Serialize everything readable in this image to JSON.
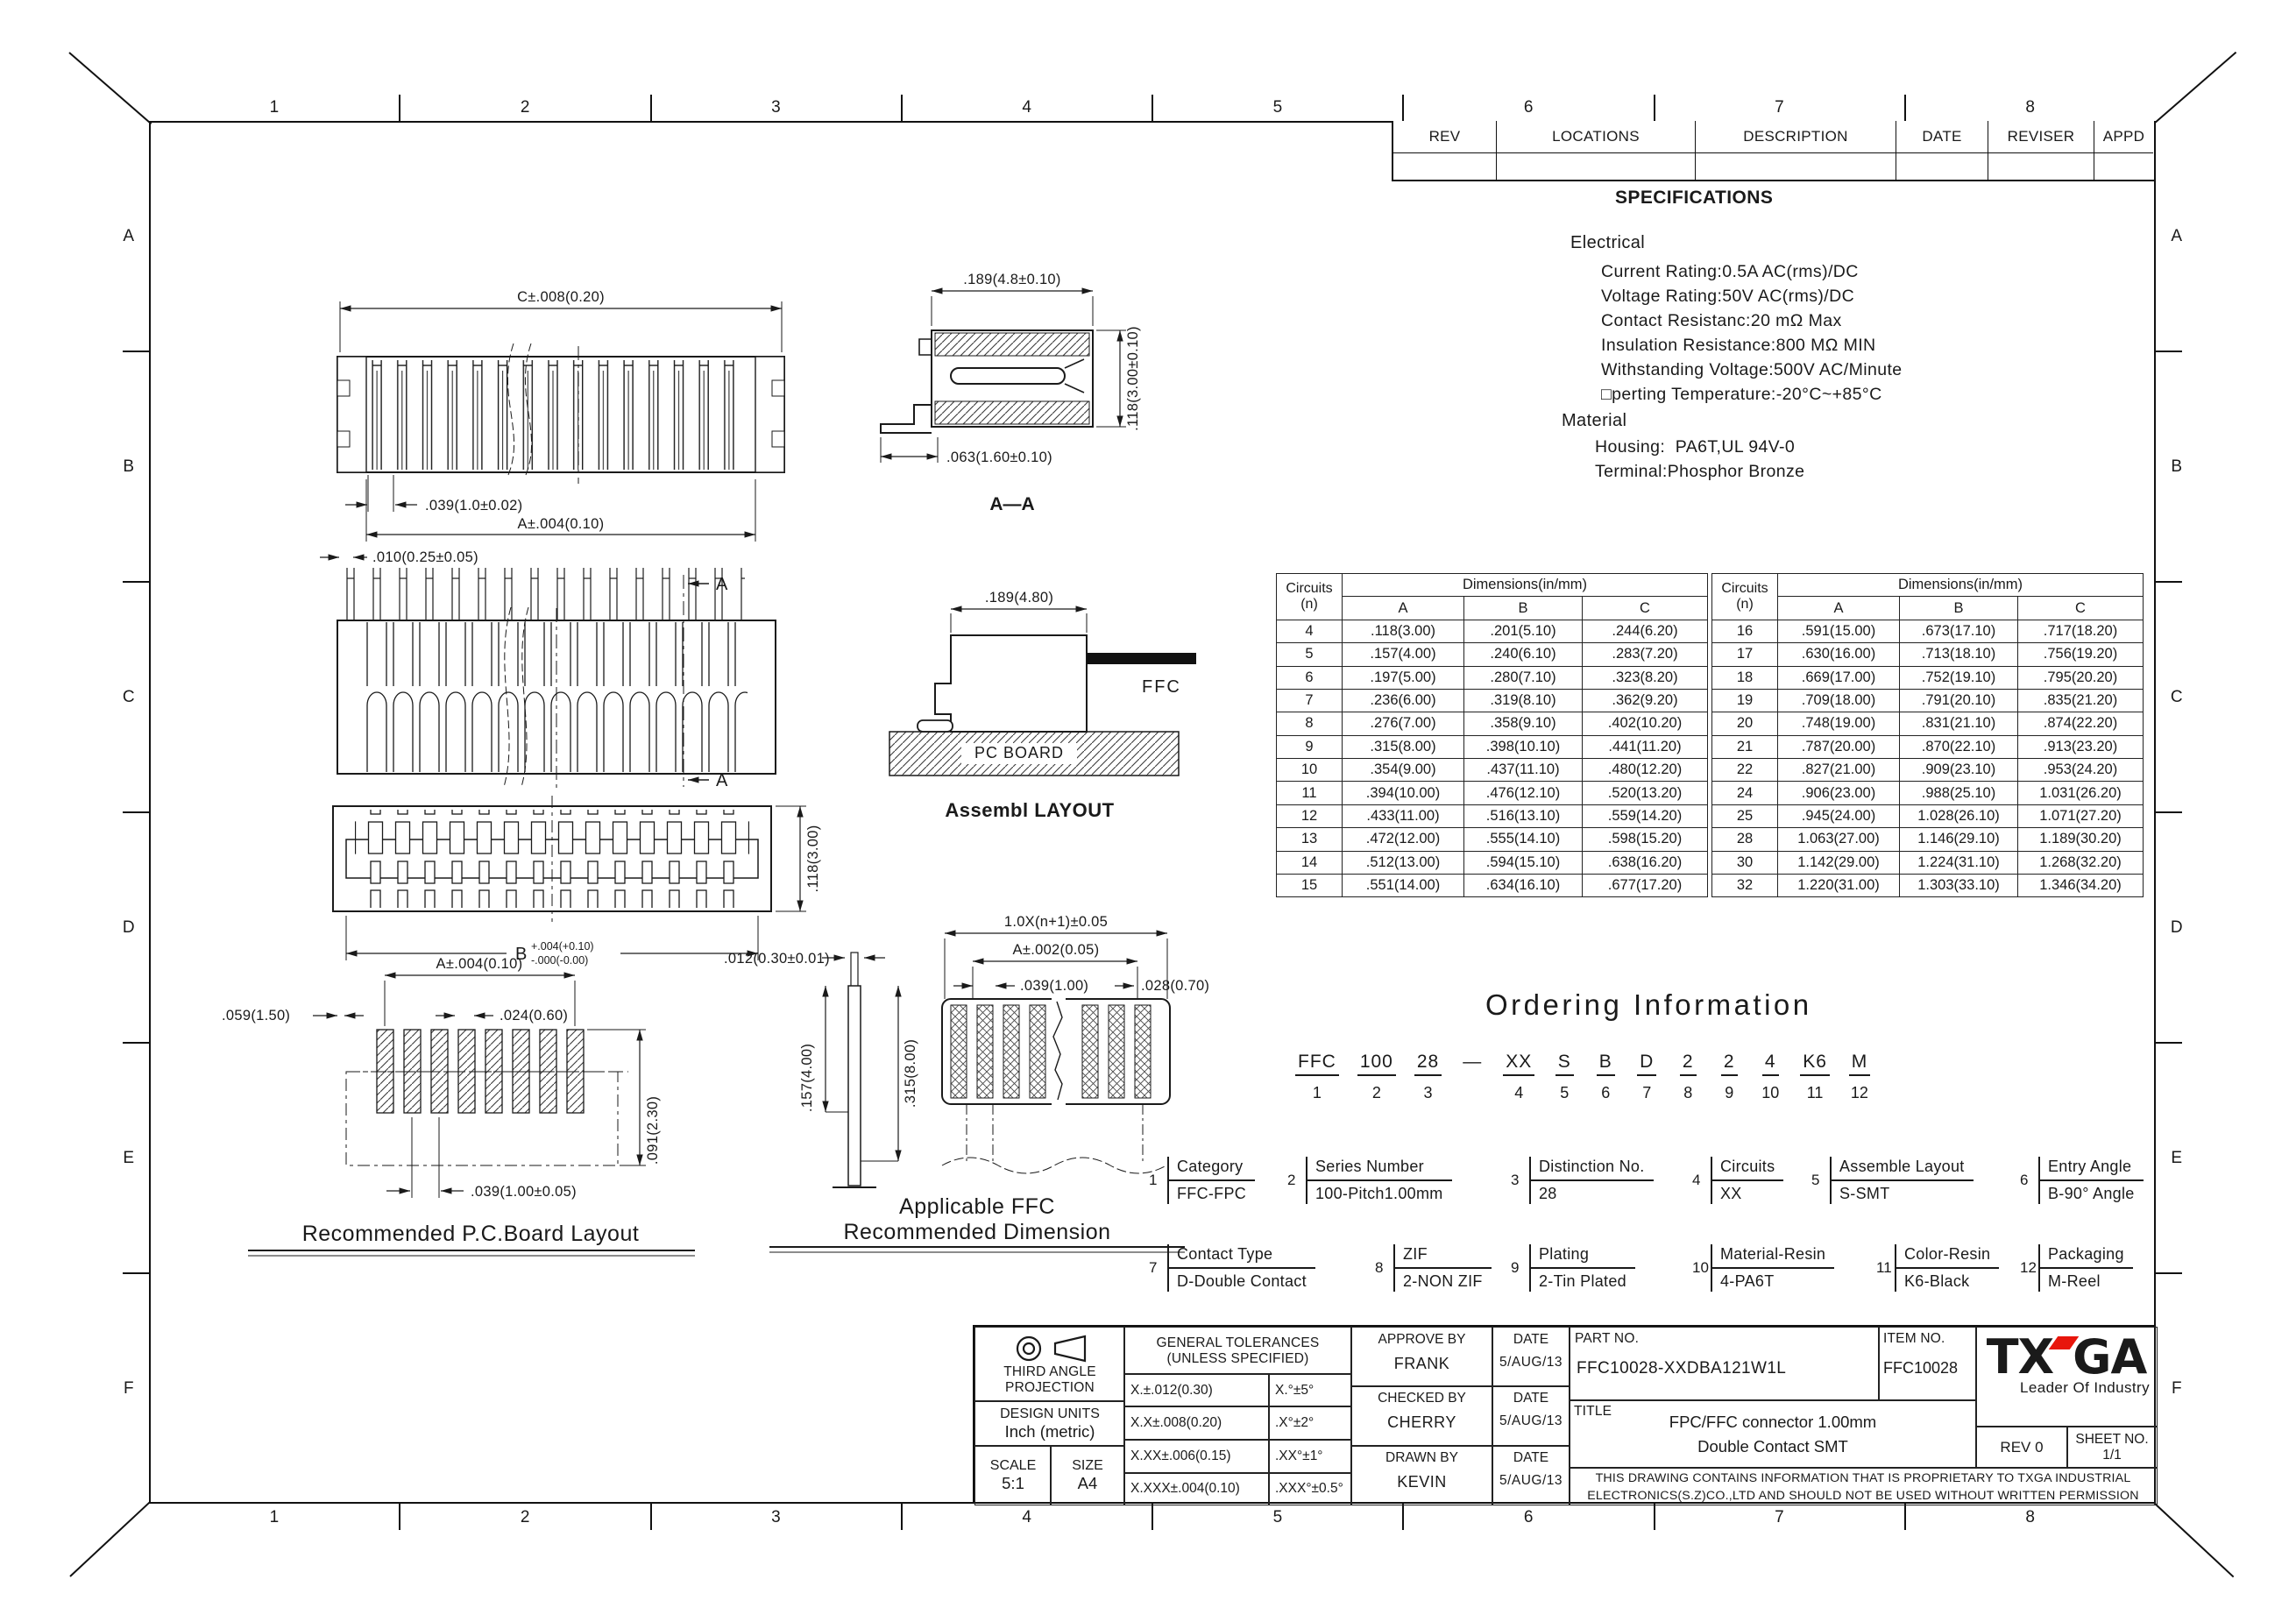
{
  "colors": {
    "line": "#1a1a1a",
    "accent_red": "#e8160c"
  },
  "frame": {
    "cols": [
      "1",
      "2",
      "3",
      "4",
      "5",
      "6",
      "7",
      "8"
    ],
    "rows": [
      "A",
      "B",
      "C",
      "D",
      "E",
      "F"
    ]
  },
  "rev_table": {
    "headers": [
      "REV",
      "LOCATIONS",
      "DESCRIPTION",
      "DATE",
      "REVISER",
      "APPD"
    ]
  },
  "specs": {
    "title": "SPECIFICATIONS",
    "sec1": "Electrical",
    "lines1": [
      "Current Rating:0.5A AC(rms)/DC",
      "Voltage Rating:50V AC(rms)/DC",
      "Contact Resistanc:20 mΩ Max",
      "Insulation Resistance:800 MΩ MIN",
      "Withstanding Voltage:500V AC/Minute",
      "□perting Temperature:-20°C~+85°C"
    ],
    "sec2": "Material",
    "lines2": [
      "Housing:  PA6T,UL 94V-0",
      "Terminal:Phosphor Bronze"
    ]
  },
  "dim_tables": {
    "header_circuits": "Circuits",
    "header_n": "(n)",
    "header_dims": "Dimensions(in/mm)",
    "col_a": "A",
    "col_b": "B",
    "col_c": "C",
    "left_rows": [
      [
        "4",
        ".118(3.00)",
        ".201(5.10)",
        ".244(6.20)"
      ],
      [
        "5",
        ".157(4.00)",
        ".240(6.10)",
        ".283(7.20)"
      ],
      [
        "6",
        ".197(5.00)",
        ".280(7.10)",
        ".323(8.20)"
      ],
      [
        "7",
        ".236(6.00)",
        ".319(8.10)",
        ".362(9.20)"
      ],
      [
        "8",
        ".276(7.00)",
        ".358(9.10)",
        ".402(10.20)"
      ],
      [
        "9",
        ".315(8.00)",
        ".398(10.10)",
        ".441(11.20)"
      ],
      [
        "10",
        ".354(9.00)",
        ".437(11.10)",
        ".480(12.20)"
      ],
      [
        "11",
        ".394(10.00)",
        ".476(12.10)",
        ".520(13.20)"
      ],
      [
        "12",
        ".433(11.00)",
        ".516(13.10)",
        ".559(14.20)"
      ],
      [
        "13",
        ".472(12.00)",
        ".555(14.10)",
        ".598(15.20)"
      ],
      [
        "14",
        ".512(13.00)",
        ".594(15.10)",
        ".638(16.20)"
      ],
      [
        "15",
        ".551(14.00)",
        ".634(16.10)",
        ".677(17.20)"
      ]
    ],
    "right_rows": [
      [
        "16",
        ".591(15.00)",
        ".673(17.10)",
        ".717(18.20)"
      ],
      [
        "17",
        ".630(16.00)",
        ".713(18.10)",
        ".756(19.20)"
      ],
      [
        "18",
        ".669(17.00)",
        ".752(19.10)",
        ".795(20.20)"
      ],
      [
        "19",
        ".709(18.00)",
        ".791(20.10)",
        ".835(21.20)"
      ],
      [
        "20",
        ".748(19.00)",
        ".831(21.10)",
        ".874(22.20)"
      ],
      [
        "21",
        ".787(20.00)",
        ".870(22.10)",
        ".913(23.20)"
      ],
      [
        "22",
        ".827(21.00)",
        ".909(23.10)",
        ".953(24.20)"
      ],
      [
        "24",
        ".906(23.00)",
        ".988(25.10)",
        "1.031(26.20)"
      ],
      [
        "25",
        ".945(24.00)",
        "1.028(26.10)",
        "1.071(27.20)"
      ],
      [
        "28",
        "1.063(27.00)",
        "1.146(29.10)",
        "1.189(30.20)"
      ],
      [
        "30",
        "1.142(29.00)",
        "1.224(31.10)",
        "1.268(32.20)"
      ],
      [
        "32",
        "1.220(31.00)",
        "1.303(33.10)",
        "1.346(34.20)"
      ]
    ]
  },
  "ordering": {
    "title": "Ordering Information",
    "codes": [
      {
        "c": "FFC",
        "n": "1"
      },
      {
        "c": "100",
        "n": "2"
      },
      {
        "c": "28",
        "n": "3"
      },
      {
        "c": "—",
        "n": ""
      },
      {
        "c": "XX",
        "n": "4"
      },
      {
        "c": "S",
        "n": "5"
      },
      {
        "c": "B",
        "n": "6"
      },
      {
        "c": "D",
        "n": "7"
      },
      {
        "c": "2",
        "n": "8"
      },
      {
        "c": "2",
        "n": "9"
      },
      {
        "c": "4",
        "n": "10"
      },
      {
        "c": "K6",
        "n": "11"
      },
      {
        "c": "M",
        "n": "12"
      }
    ],
    "legend": [
      {
        "num": "1",
        "label": "Category",
        "value": "FFC-FPC"
      },
      {
        "num": "2",
        "label": "Series Number",
        "value": "100-Pitch1.00mm"
      },
      {
        "num": "3",
        "label": "Distinction No.",
        "value": "28"
      },
      {
        "num": "4",
        "label": "Circuits",
        "value": "XX"
      },
      {
        "num": "5",
        "label": "Assemble Layout",
        "value": "S-SMT"
      },
      {
        "num": "6",
        "label": "Entry Angle",
        "value": "B-90° Angle"
      },
      {
        "num": "7",
        "label": "Contact Type",
        "value": "D-Double Contact"
      },
      {
        "num": "8",
        "label": "ZIF",
        "value": "2-NON ZIF"
      },
      {
        "num": "9",
        "label": "Plating",
        "value": "2-Tin Plated"
      },
      {
        "num": "10",
        "label": "Material-Resin",
        "value": "4-PA6T"
      },
      {
        "num": "11",
        "label": "Color-Resin",
        "value": "K6-Black"
      },
      {
        "num": "12",
        "label": "Packaging",
        "value": "M-Reel"
      }
    ]
  },
  "title_block": {
    "projection_line1": "THIRD ANGLE",
    "projection_line2": "PROJECTION",
    "design_units_label": "DESIGN UNITS",
    "design_units_value": "Inch (metric)",
    "scale_label": "SCALE",
    "scale_value": "5:1",
    "size_label": "SIZE",
    "size_value": "A4",
    "tol_title1": "GENERAL TOLERANCES",
    "tol_title2": "(UNLESS SPECIFIED)",
    "tol_rows": [
      [
        "X.±.012(0.30)",
        "X.°±5°"
      ],
      [
        "X.X±.008(0.20)",
        ".X°±2°"
      ],
      [
        "X.XX±.006(0.15)",
        ".XX°±1°"
      ],
      [
        "X.XXX±.004(0.10)",
        ".XXX°±0.5°"
      ]
    ],
    "approvals": [
      {
        "role": "APPROVE BY",
        "name": "FRANK",
        "date_label": "DATE",
        "date": "5/AUG/13"
      },
      {
        "role": "CHECKED BY",
        "name": "CHERRY",
        "date_label": "DATE",
        "date": "5/AUG/13"
      },
      {
        "role": "DRAWN BY",
        "name": "KEVIN",
        "date_label": "DATE",
        "date": "5/AUG/13"
      }
    ],
    "part_no_label": "PART NO.",
    "part_no": "FFC10028-XXDBA121W1L",
    "item_no_label": "ITEM NO.",
    "item_no": "FFC10028",
    "title_label": "TITLE",
    "title_line1": "FPC/FFC connector 1.00mm",
    "title_line2": "Double Contact SMT",
    "logo_left": "TX",
    "logo_right": "GA",
    "logo_tagline": "Leader Of Industry",
    "rev": "REV 0",
    "sheet": "SHEET NO. 1/1",
    "disclaimer_line1": "THIS DRAWING CONTAINS INFORMATION THAT IS PROPRIETARY TO TXGA INDUSTRIAL",
    "disclaimer_line2": "ELECTRONICS(S.Z)CO.,LTD AND SHOULD NOT BE USED WITHOUT WRITTEN PERMISSION"
  },
  "views": {
    "top_view": {
      "dim_c": "C±.008(0.20)",
      "dim_pitch": ".039(1.0±0.02)",
      "dim_a": "A±.004(0.10)"
    },
    "section": {
      "dim_w": ".189(4.8±0.10)",
      "dim_foot": ".063(1.60±0.10)",
      "dim_h": ".118(3.00±0.10)",
      "label": "A—A"
    },
    "front": {
      "dim_pin": ".010(0.25±0.05)",
      "marker": "A"
    },
    "assembly": {
      "dim": ".189(4.80)",
      "ffc": "FFC",
      "board": "PC BOARD",
      "caption": "Assembl LAYOUT"
    },
    "bottom": {
      "dim_h": ".118(3.00)",
      "b": "B",
      "b_sup": "+.004(+0.10)",
      "b_sub": "-.000(-0.00)"
    },
    "pcb": {
      "dim_a": "A±.004(0.10)",
      "dim_left": ".059(1.50)",
      "dim_pad": ".024(0.60)",
      "dim_pitch": ".039(1.00±0.05)",
      "dim_h": ".091(2.30)",
      "caption": "Recommended P.C.Board Layout"
    },
    "ffc": {
      "dim_t": ".012(0.30±0.01)",
      "dim_b1": ".157(4.00)",
      "dim_b2": ".315(8.00)",
      "dim_total": "1.0X(n+1)±0.05",
      "dim_a": "A±.002(0.05)",
      "dim_p": ".039(1.00)",
      "typ": "TYP.",
      "dim_end": ".028(0.70)",
      "caption1": "Applicable FFC",
      "caption2": "Recommended Dimension"
    }
  }
}
